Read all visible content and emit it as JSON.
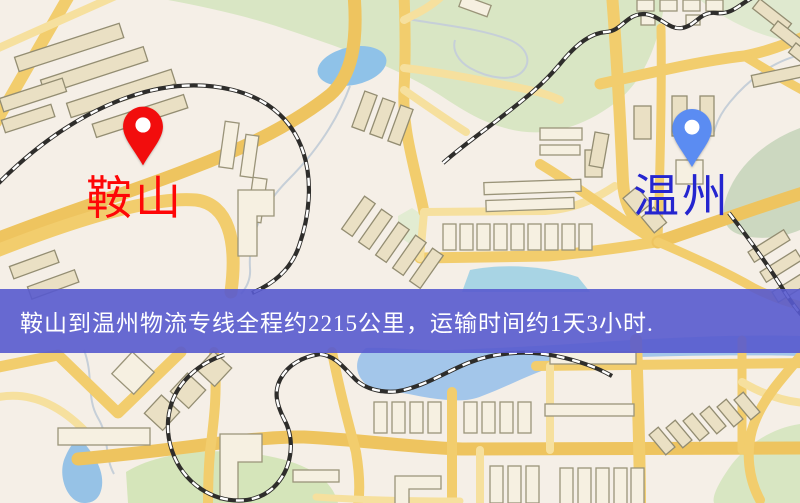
{
  "banner": {
    "text": "鞍山到温州物流专线全程约2215公里，运输时间约1天3小时.",
    "background_color": "#585acd",
    "text_color": "#ffffff"
  },
  "markers": {
    "origin": {
      "label": "鞍山",
      "label_color": "#fe0606",
      "pin_color": "#f20d0d",
      "pin_inner_color": "#ffffff"
    },
    "destination": {
      "label": "温州",
      "label_color": "#2525cf",
      "pin_color": "#5b8cf2",
      "pin_inner_color": "#ffffff"
    }
  },
  "map_colors": {
    "background": "#f5efe7",
    "road_major": "#f2cd6d",
    "road_minor": "#f6e09e",
    "building": "#eae0c4",
    "park": "#d7e5c0",
    "water": "#9cc3e8",
    "railway": "#2e2d2b"
  }
}
